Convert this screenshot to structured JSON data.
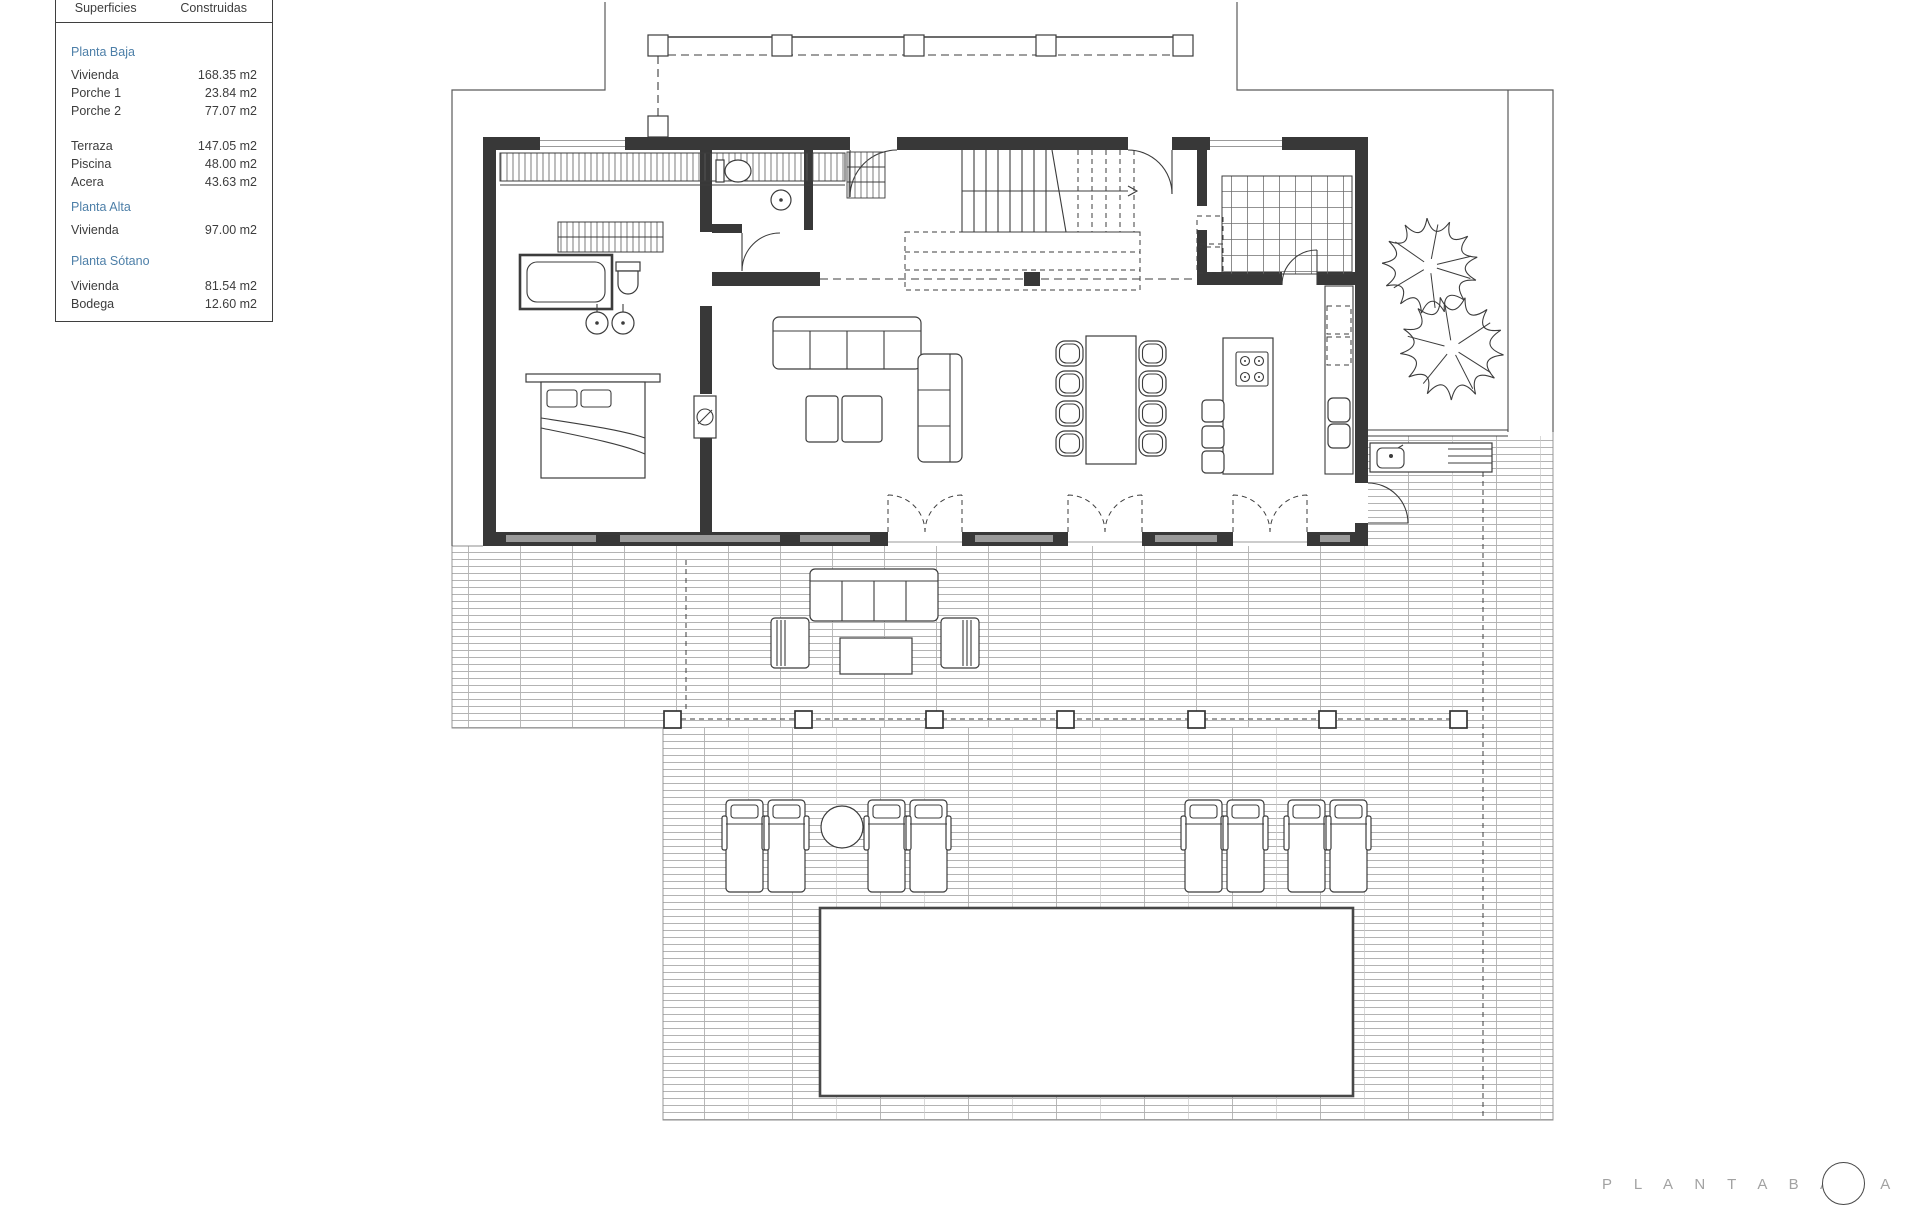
{
  "legend": {
    "col1_header": "Superficies",
    "col2_header": "Construidas",
    "rows": [
      {
        "label": "Planta Baja",
        "value": ""
      },
      {
        "label": "Vivienda",
        "value": "168.35 m2"
      },
      {
        "label": "Porche 1",
        "value": "23.84 m2"
      },
      {
        "label": "Porche 2",
        "value": "77.07 m2"
      },
      {
        "label": "Terraza",
        "value": "147.05 m2"
      },
      {
        "label": "Piscina",
        "value": "48.00 m2"
      },
      {
        "label": "Acera",
        "value": "43.63 m2"
      },
      {
        "label": "Planta Alta",
        "value": ""
      },
      {
        "label": "Vivienda",
        "value": "97.00 m2"
      },
      {
        "label": "Planta Sótano",
        "value": ""
      },
      {
        "label": "Vivienda",
        "value": "81.54 m2"
      },
      {
        "label": "Bodega",
        "value": "12.60 m2"
      }
    ]
  },
  "plan": {
    "title": "P L A N T A   B A J A"
  },
  "colors": {
    "accent_blue": "#4d7fa8",
    "line_dark": "#3c3c3c",
    "paving_gray": "#b3b3b3",
    "title_gray": "#a2a2a2"
  }
}
